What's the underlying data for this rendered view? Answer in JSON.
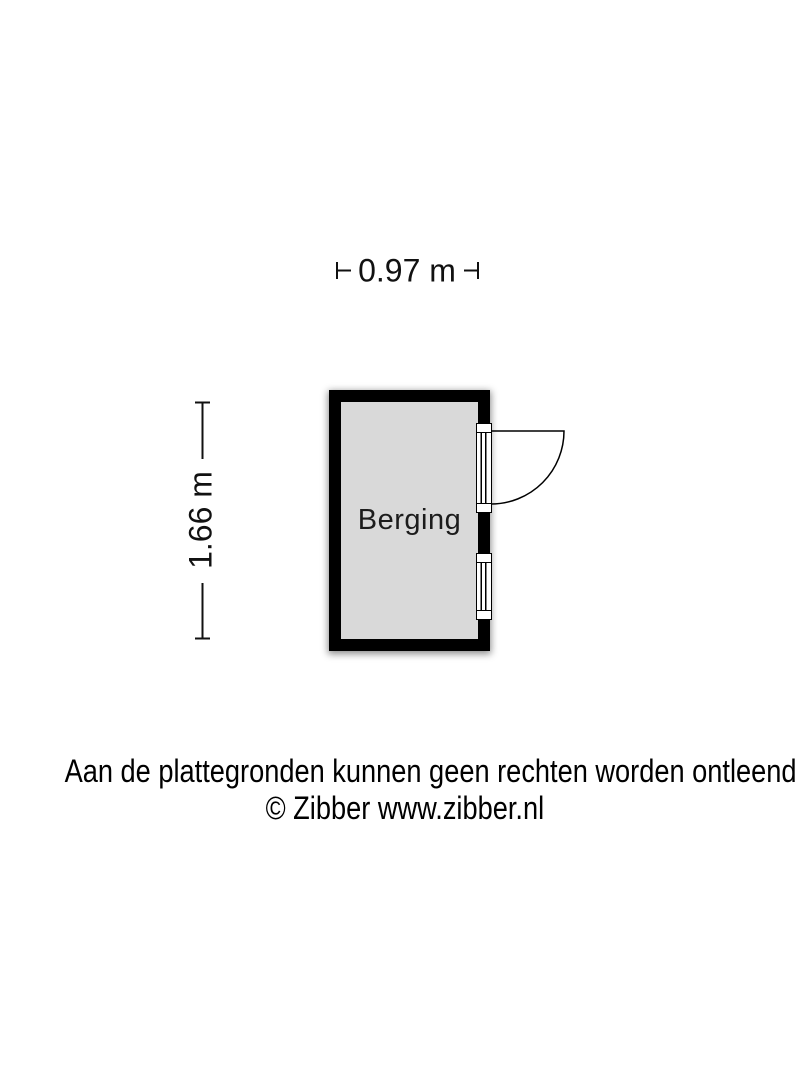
{
  "floorplan": {
    "room": {
      "label": "Berging",
      "fill_color": "#d9d9d9"
    },
    "dimensions": {
      "width_label": "0.97 m",
      "height_label": "1.66 m"
    },
    "wall_color": "#000000",
    "background_color": "#ffffff",
    "text_color": "#111111",
    "symbols": [
      {
        "name": "door-icon",
        "wall": "right",
        "position": "top",
        "swing": "outward-right"
      },
      {
        "name": "window-icon",
        "wall": "right",
        "position": "bottom"
      }
    ]
  },
  "footer": {
    "disclaimer": "Aan de plattegronden kunnen geen rechten worden ontleend",
    "copyright": "© Zibber www.zibber.nl"
  }
}
